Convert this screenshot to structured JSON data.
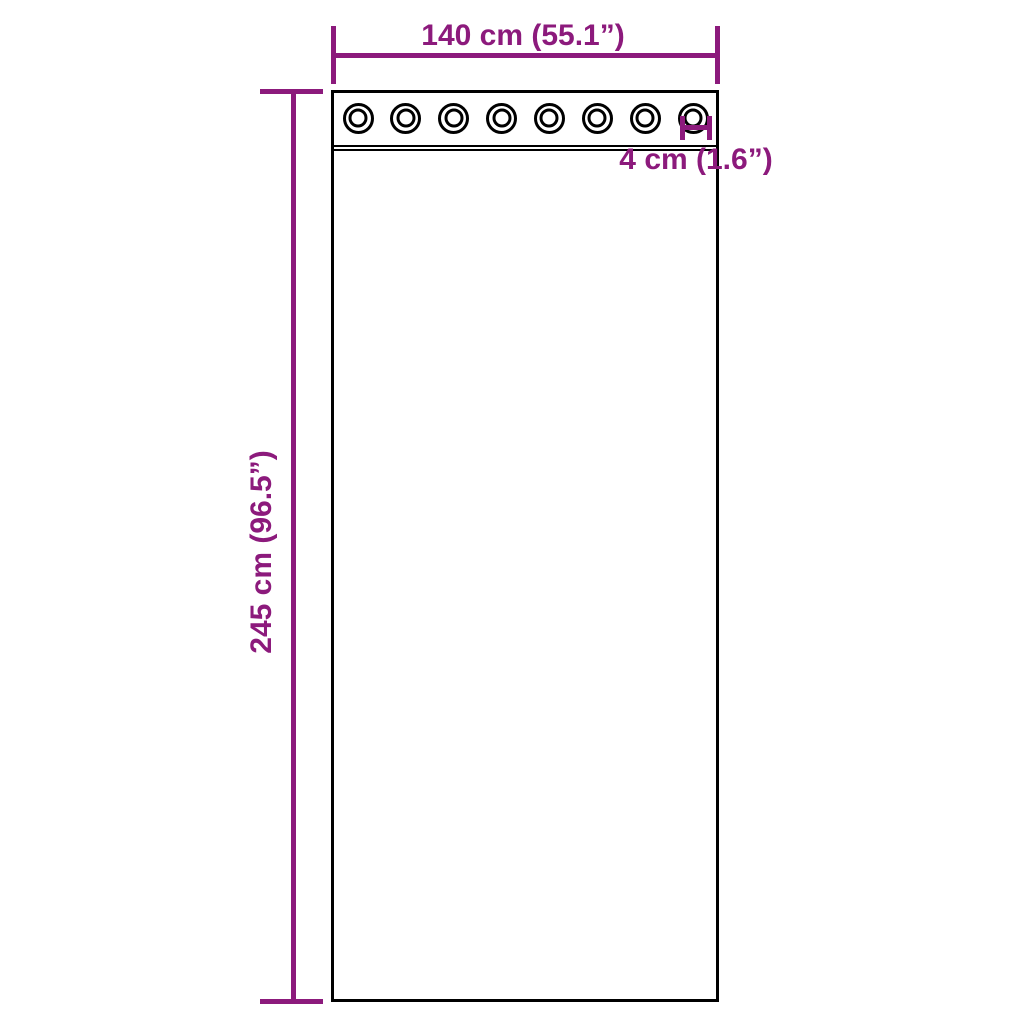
{
  "diagram": {
    "title": "curtain-with-grommets-dimension-diagram"
  },
  "dimensions": {
    "width": {
      "label": "140 cm (55.1”)"
    },
    "height": {
      "label": "245 cm (96.5”)"
    },
    "grommet": {
      "label": "4 cm (1.6”)"
    }
  },
  "curtain": {
    "grommet_count": 8,
    "grommet_row_first_center_x": 358,
    "grommet_row_spacing": 47.86,
    "grommet_center_y": 118
  },
  "colors": {
    "dimension": "#8C1A7C",
    "outline": "#000000",
    "background": "#FFFFFF"
  }
}
